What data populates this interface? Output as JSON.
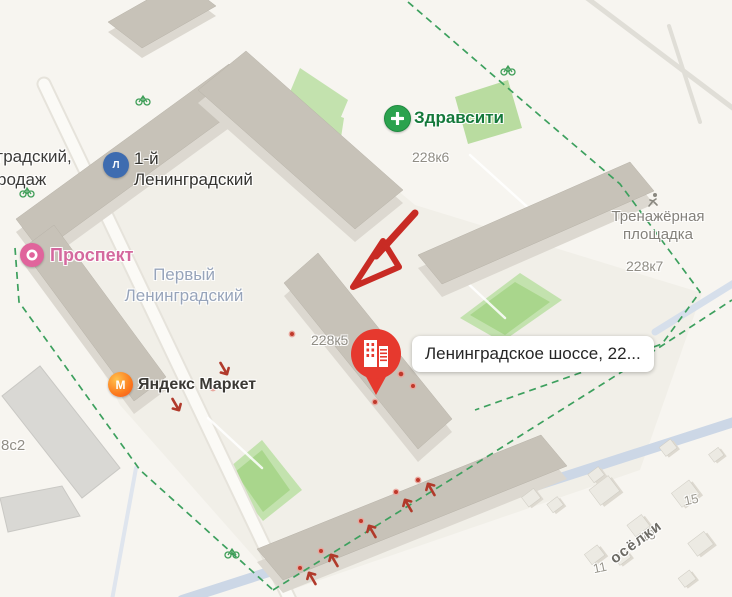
{
  "colors": {
    "background": "#f7f5f0",
    "boundary_green": "#3da05e",
    "annotation_red": "#c82b24",
    "pin_red": "#e6392e",
    "road_blue": "#ccd7e6",
    "building_roof": "#c7c2b8",
    "building_wall": "#dcd8d0",
    "park_green": "#c3e2ae",
    "prospekt_pink": "#d4689e",
    "zdravcity_green": "#2ba24e",
    "company_blue": "#3e6cb0",
    "market_orange": "#fc9b1d"
  },
  "balloon": {
    "label": "Ленинградское шоссе, 22..."
  },
  "pois": {
    "zdravcity": {
      "label": "Здравсити"
    },
    "company": {
      "line1": "1-й",
      "line2": "Ленинградский"
    },
    "prospekt": {
      "label": "Проспект"
    },
    "market": {
      "label": "Яндекс Маркет"
    },
    "gym": {
      "line1": "Тренажёрная",
      "line2": "площадка"
    },
    "district": {
      "line1": "Первый",
      "line2": "Ленинградский"
    },
    "cutoff": {
      "line1": "градский,",
      "line2": "родаж"
    }
  },
  "buildings": {
    "b228k6": "228к6",
    "b228k7": "228к7",
    "b228k5": "228к5",
    "b8s2": "8с2"
  },
  "houses": {
    "h15": "15",
    "h13": "13",
    "h11": "11"
  },
  "street": {
    "name": "осёлки"
  },
  "icons": {
    "pharmacy": "plus-icon",
    "company": "company-logo-icon",
    "prospekt": "ring-icon",
    "market": "flame-icon",
    "gym": "runner-icon",
    "pin": "building-pin-icon",
    "entrances": "entrance-arrow-icon",
    "bikes": "bicycle-icon",
    "annotation": "hand-drawn-arrow"
  }
}
